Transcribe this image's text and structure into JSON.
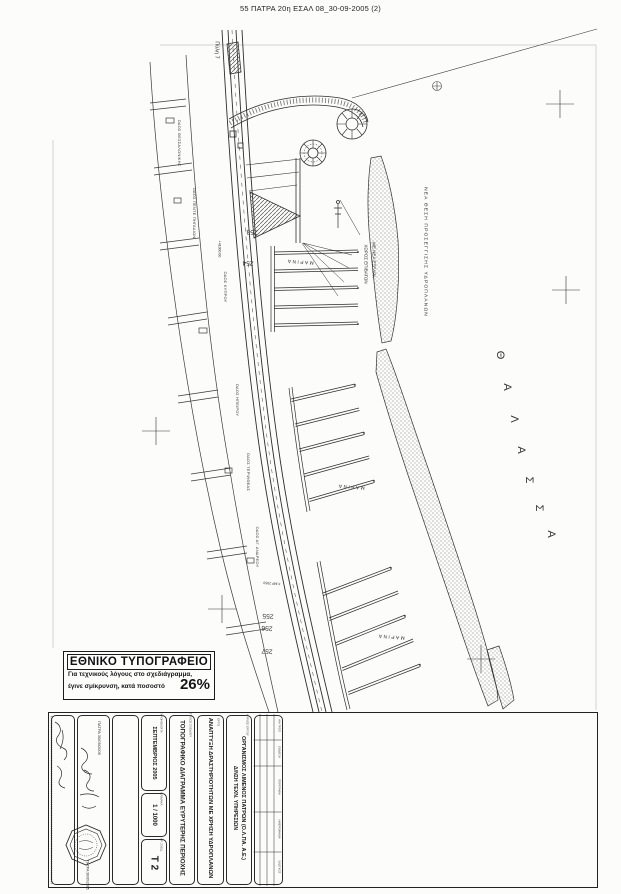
{
  "page": {
    "header_title": "55 ΠΑΤΡΑ 20η ΕΣΑΛ 08_30-09-2005 (2)"
  },
  "colors": {
    "ink": "#2b2b2b",
    "paper": "#fcfcfa"
  },
  "map": {
    "gate_label": "Πύλη 7",
    "seaplane_area_label": "ΝΕΑ ΘΕΣΗ ΠΡΟΣΕΓΓΙΣΗΣ ΥΔΡΟΠΛΑΝΩΝ",
    "passenger_area_line1": "ΧΩΡΟΣ ΕΠΙΒΑΤΩΝ",
    "passenger_area_line2": "ΜΕ ΝΕΑ ΕΞΕΔΡΑ",
    "marina_upper": "ΜΑΡΙΝΑ",
    "marina_mid": "ΜΑΡΙΝΑ",
    "marina_lower": "ΜΑΡΙΝΑ",
    "sea_letters": [
      "Θ",
      "Α",
      "Λ",
      "Α",
      "Σ",
      "Σ",
      "Α"
    ],
    "blocks": {
      "b1": "253",
      "b2": "254",
      "b3": "255",
      "b4": "256",
      "b5": "257"
    },
    "coordinate_label": "+41000.00",
    "benchmark_label": "Χ.ΜΡ 2050",
    "streets": [
      "ΟΔΟΣ ΘΕΣΣΑΛΟΝΙΚΗΣ",
      "ΟΔΟΣ ΠΕΝΤΕ ΠΗΓΑΔΙΩΝ",
      "ΟΔΟΣ ΚΥΠΡΟΥ",
      "ΟΔΟΣ ΗΠΕΙΡΟΥ",
      "ΟΔΟΣ ΤΕΡΨΙΘΕΑΣ",
      "ΟΔΟΣ ΑΓ. ΑΝΔΡΕΟΥ"
    ]
  },
  "reduction_stamp": {
    "title": "ΕΘΝΙΚΟ ΤΥΠΟΓΡΑΦΕΙΟ",
    "line1": "Για τεχνικούς λόγους στο σχεδιάγραμμα,",
    "line2": "έγινε σμίκρυνση, κατά ποσοστό",
    "percent": "26%"
  },
  "title_block": {
    "date_header": "ΧΡΟΝΟΛΟΓΙΑ",
    "date_value": "ΣΕΠΤΕΜΒΡΙΟΣ 2005",
    "scale_header": "ΚΛΙΜΑΚΑ",
    "scale_value": "1 / 1000",
    "number_header": "ΑΡ. ΣΧΕΔ.",
    "number_value": "Τ 2",
    "title_header": "ΤΙΤΛΟΣ ΣΧΕΔΙΟΥ",
    "title_value": "ΤΟΠΟΓΡΑΦΙΚΟ ΔΙΑΓΡΑΜΜΑ ΕΥΡΥΤΕΡΗΣ ΠΕΡΙΟΧΗΣ",
    "project_header": "ΕΡΓΟ",
    "project_value": "ΑΝΑΠΤΥΞΗ ΔΡΑΣΤΗΡΙΟΤΗΤΩΝ ΜΕ ΧΡΗΣΗ ΥΔΡΟΠΛΑΝΩΝ",
    "owner_header": "ΚΥΡΙΟΣ ΕΡΓΟΥ",
    "owner_line1": "ΟΡΓΑΝΙΣΜΟΣ ΛΙΜΕΝΟΣ ΠΑΤΡΩΝ (Ο.Λ.ΠΑ. Α.Ε.)",
    "owner_line2": "Δ/ΝΣΗ ΤΕΧΝ. ΥΠΗΡΕΣΙΩΝ",
    "approval_date_top": "ΠΑΤΡΑ 30/09/2005",
    "approval_date_bottom": "ΠΑΤΡΑ 30/09/2005",
    "revision_headers": [
      "Α/Α ΤΡΟΠ.",
      "ΕΝΔΕΙΞΗ",
      "ΠΕΡΙΓΡΑΦΗ",
      "ΗΜΕΡΟΜΗΝΙΑ",
      "ΕΛΕΓΧΟΣ"
    ]
  }
}
